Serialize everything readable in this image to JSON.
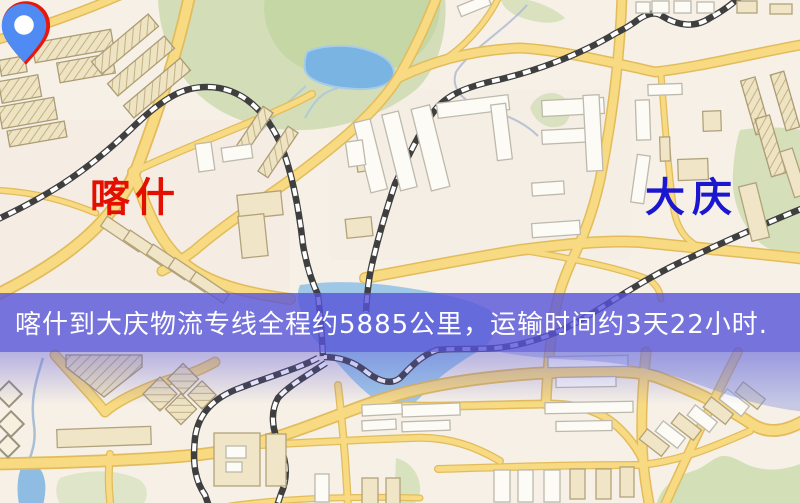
{
  "map": {
    "banner": {
      "text": "喀什到大庆物流专线全程约5885公里，运输时间约3天22小时.",
      "bg_color": "#5854da",
      "text_color": "#ffffff",
      "distance_text": "约5885公里",
      "duration_text": "约3天22小时"
    },
    "origin_marker": {
      "label": "喀什",
      "icon": "map-pin",
      "pin_color": "#e8170a",
      "label_color": "#e31000"
    },
    "destination_marker": {
      "label": "大庆",
      "icon": "map-pin",
      "pin_color": "#4f8bf2",
      "label_color": "#1b16cf"
    },
    "palette": {
      "background": "#f6f0e6",
      "road_fill": "#f7da82",
      "road_casing": "#e2bc5c",
      "water": "#9fc8e6",
      "park": "#cfdcb2",
      "railway": "#3f3f3f",
      "building_beige": "#f0e6c7",
      "building_white": "#fcfbf6"
    }
  }
}
